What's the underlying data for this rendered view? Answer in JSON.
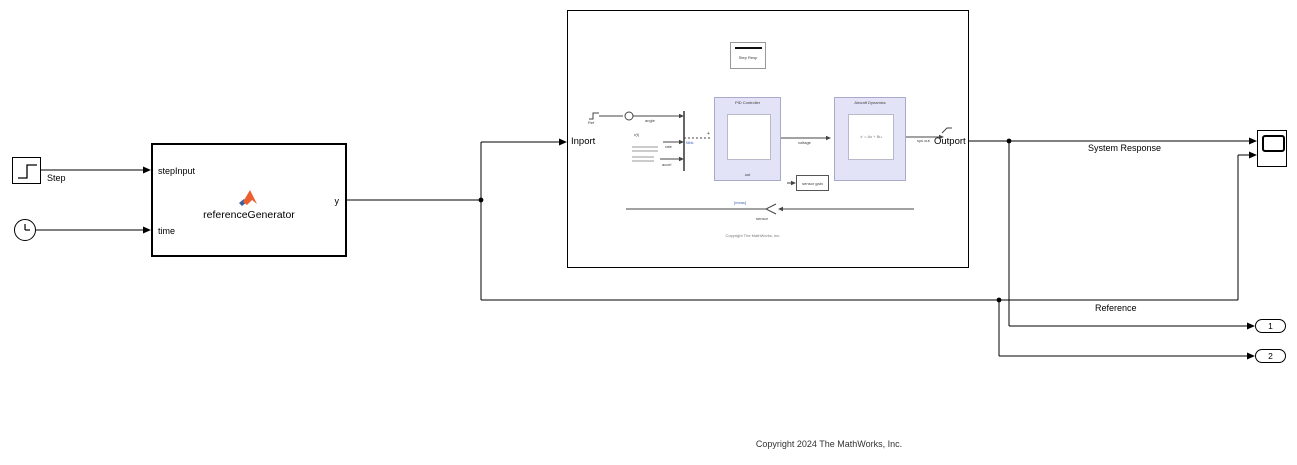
{
  "copyright": "Copyright 2024 The MathWorks, Inc.",
  "signal_labels": {
    "system_response": "System Response",
    "reference": "Reference"
  },
  "blocks": {
    "step": {
      "label": "Step"
    },
    "reference_generator": {
      "title": "referenceGenerator",
      "in1": "stepInput",
      "in2": "time",
      "out1": "y"
    },
    "subsystem": {
      "inport": "Inport",
      "outport": "Outport",
      "preview": {
        "check_block": "Step Resp",
        "source_label": "Ref",
        "sig_angle": "angle",
        "sig_r": "r(t)",
        "sig_rate": "rate",
        "sig_accel": "accel",
        "bus_tag": "fdbk",
        "plus": "+",
        "pid_title": "PID Controller",
        "pid_caption": "out",
        "plant_title": "Aircraft Dynamics",
        "plant_caption": "x' = Ax + Bu",
        "sig_voltage": "voltage",
        "out_label": "sys out",
        "gain_block": "sensor gain",
        "fb_tag": "[meas]",
        "fb_label": "sensor",
        "annotation": "Copyright The MathWorks, Inc."
      }
    },
    "outports": [
      {
        "label": "1"
      },
      {
        "label": "2"
      }
    ]
  },
  "colors": {
    "area_fill": "#e2e3f7",
    "area_border": "#a9aacb",
    "wire": "#000000",
    "matlab_orange": "#ea5f2d",
    "matlab_blue": "#3a5f9f"
  }
}
